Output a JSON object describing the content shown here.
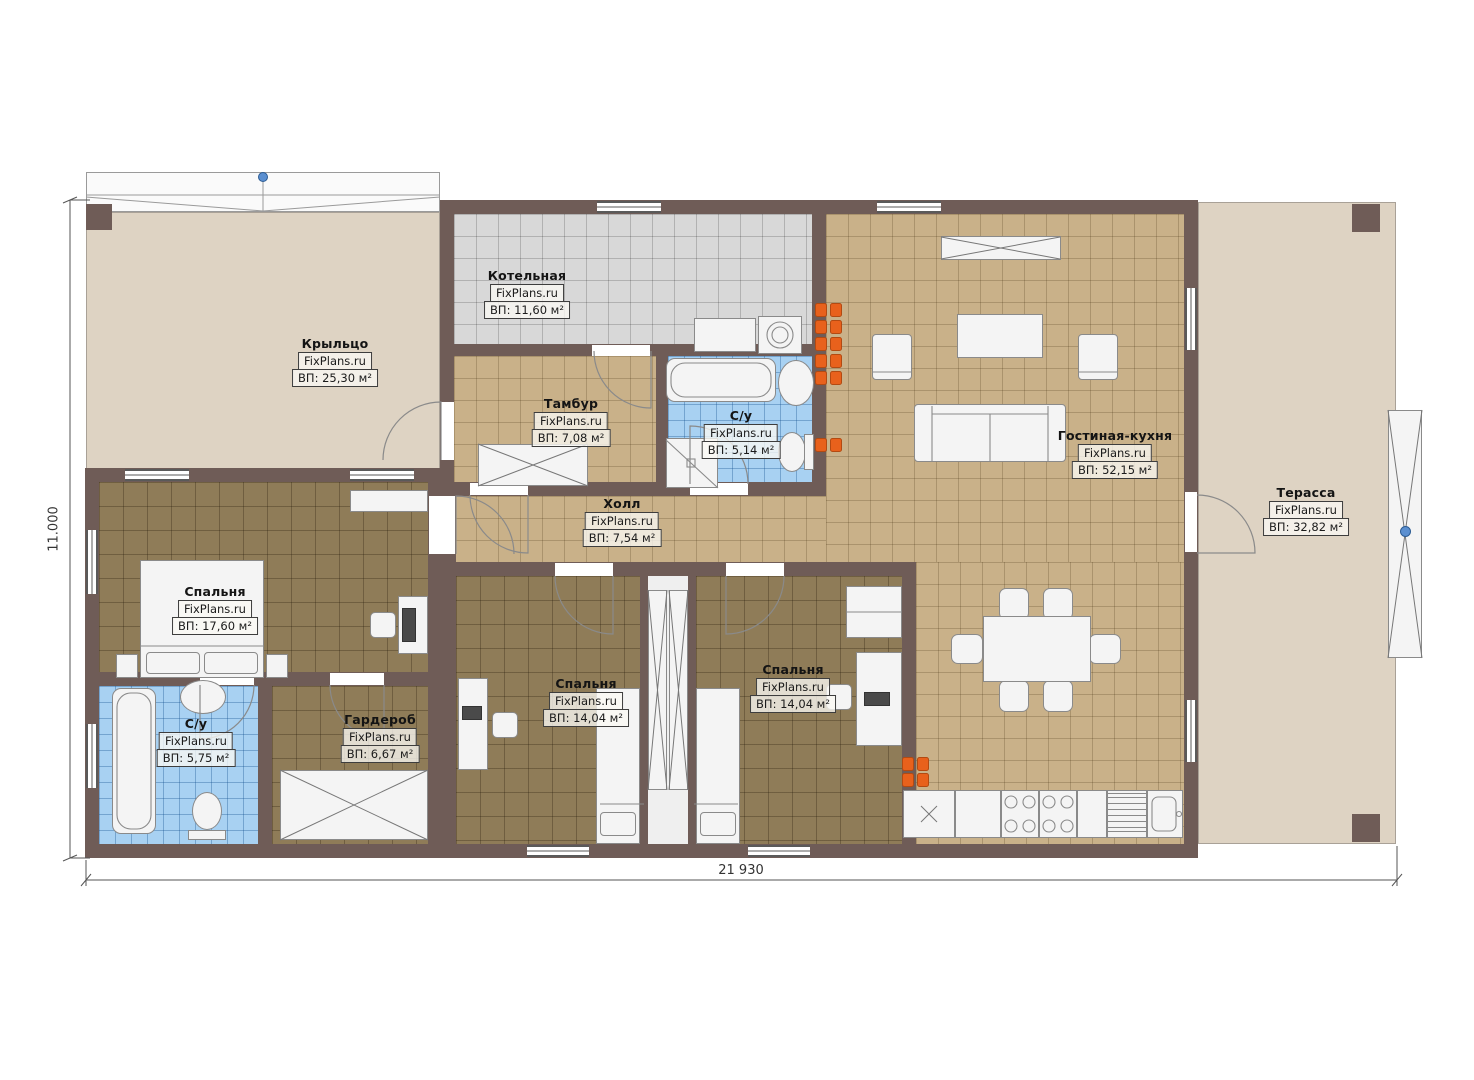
{
  "dimensions": {
    "width_label": "21 930",
    "height_label": "11.000"
  },
  "rooms": {
    "porch": {
      "name": "Крыльцо",
      "watermark": "FixPlans.ru",
      "area": "ВП: 25,30 м²"
    },
    "boiler": {
      "name": "Котельная",
      "watermark": "FixPlans.ru",
      "area": "ВП: 11,60 м²"
    },
    "tambour": {
      "name": "Тамбур",
      "watermark": "FixPlans.ru",
      "area": "ВП: 7,08 м²"
    },
    "bath_top": {
      "name": "С/у",
      "watermark": "FixPlans.ru",
      "area": "ВП: 5,14 м²"
    },
    "living": {
      "name": "Гостиная-кухня",
      "watermark": "FixPlans.ru",
      "area": "ВП: 52,15 м²"
    },
    "hall": {
      "name": "Холл",
      "watermark": "FixPlans.ru",
      "area": "ВП: 7,54 м²"
    },
    "terrace": {
      "name": "Терасса",
      "watermark": "FixPlans.ru",
      "area": "ВП: 32,82 м²"
    },
    "bedroom_left": {
      "name": "Спальня",
      "watermark": "FixPlans.ru",
      "area": "ВП: 17,60 м²"
    },
    "bath_bottom": {
      "name": "С/у",
      "watermark": "FixPlans.ru",
      "area": "ВП: 5,75 м²"
    },
    "wardrobe": {
      "name": "Гардероб",
      "watermark": "FixPlans.ru",
      "area": "ВП: 6,67 м²"
    },
    "bedroom_mid": {
      "name": "Спальня",
      "watermark": "FixPlans.ru",
      "area": "ВП: 14,04 м²"
    },
    "bedroom_right": {
      "name": "Спальня",
      "watermark": "FixPlans.ru",
      "area": "ВП: 14,04 м²"
    }
  },
  "colors": {
    "wall": "#6f5c57",
    "floor_tan": "#c9b189",
    "floor_brown": "#8f7c58",
    "floor_blue": "#a8d1f2",
    "floor_gray": "#d8d8d8",
    "outdoor": "#ded3c3",
    "marker_orange": "#e8611c",
    "marker_blue": "#5b8fd0"
  }
}
